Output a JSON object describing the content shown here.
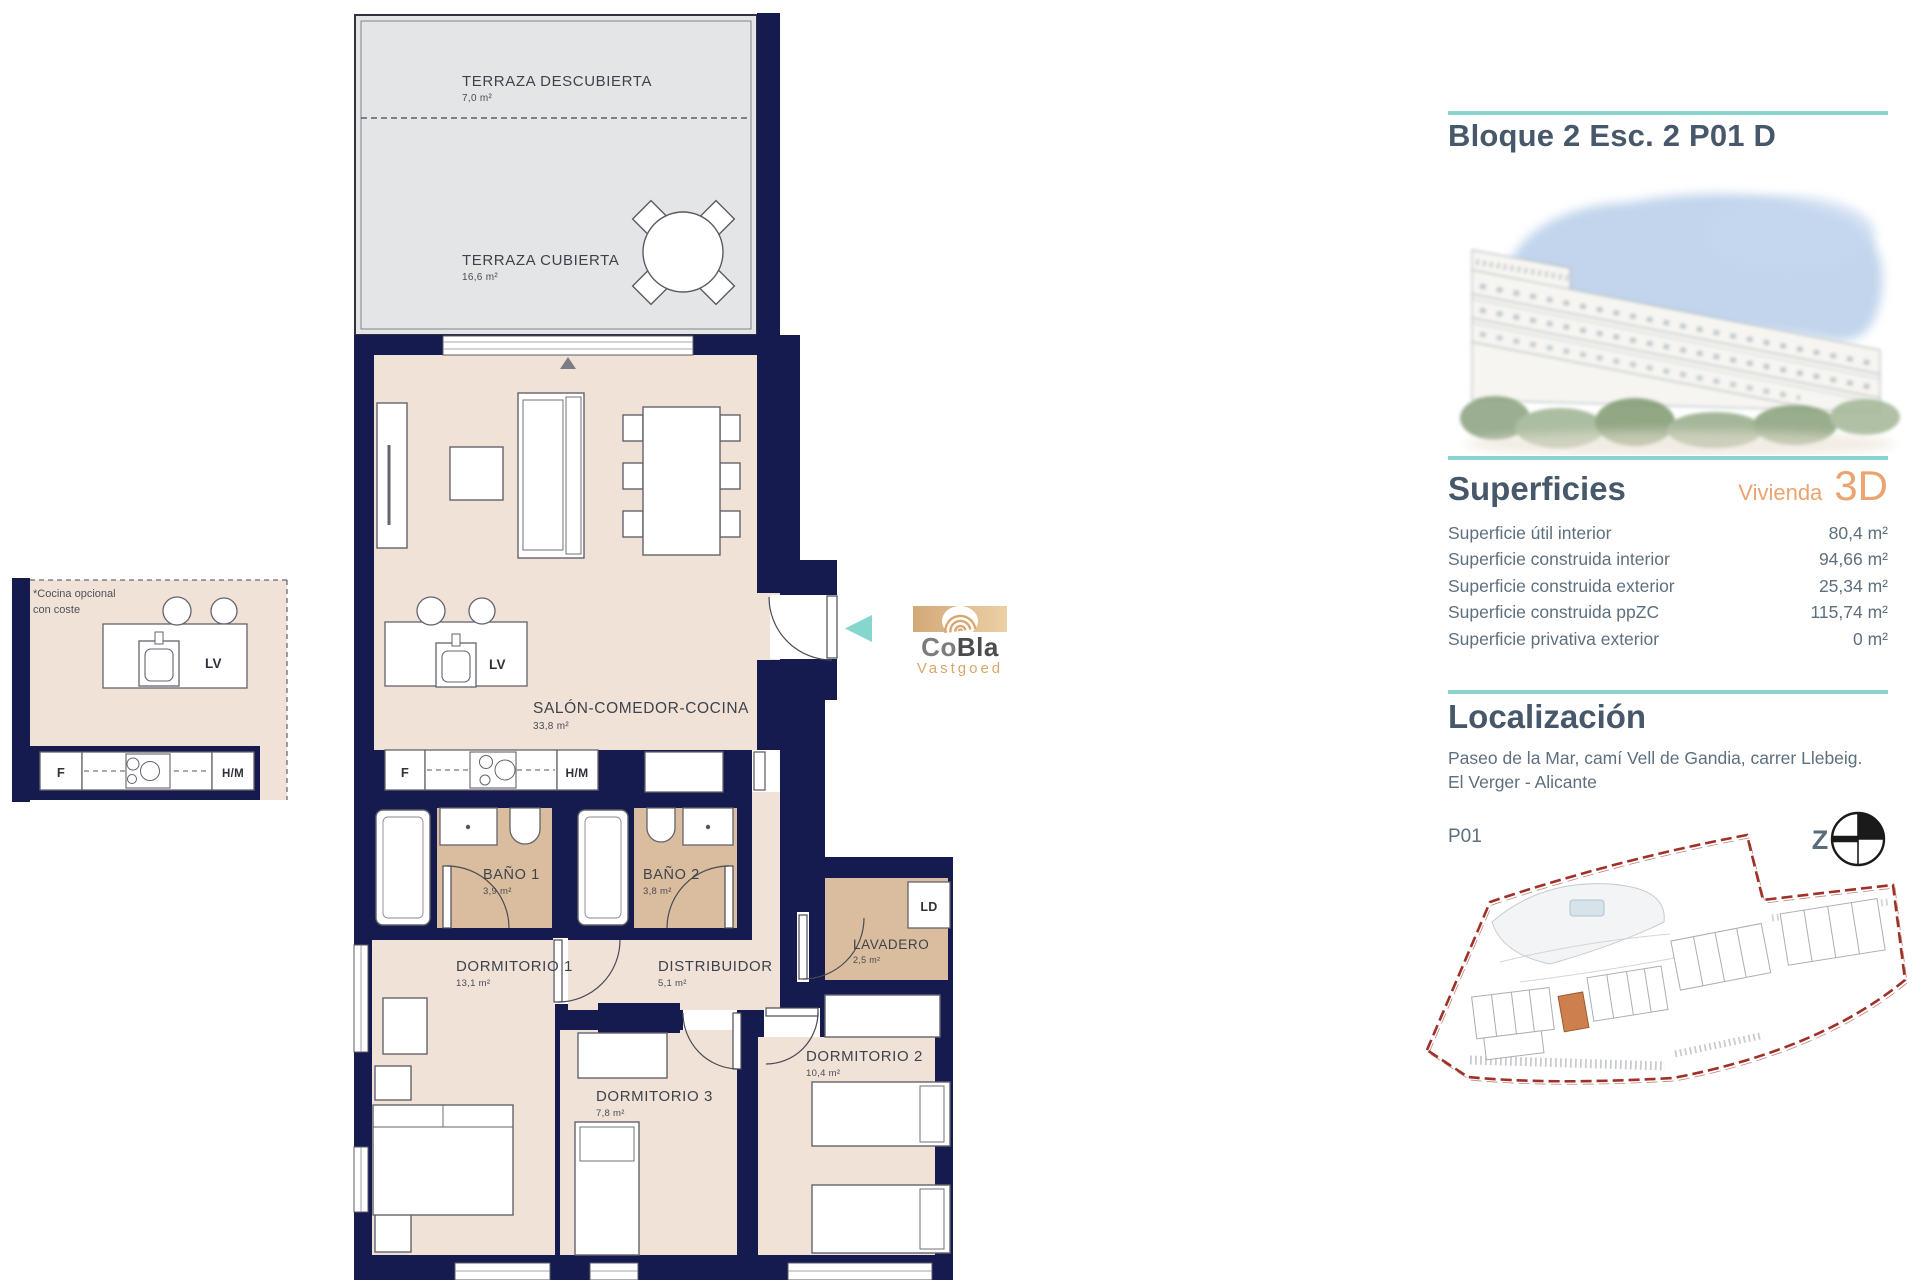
{
  "plan": {
    "rooms": {
      "terraza_descubierta": {
        "name": "TERRAZA DESCUBIERTA",
        "area": "7,0 m²"
      },
      "terraza_cubierta": {
        "name": "TERRAZA CUBIERTA",
        "area": "16,6 m²"
      },
      "salon": {
        "name": "SALÓN-COMEDOR-COCINA",
        "area": "33,8 m²"
      },
      "bano1": {
        "name": "BAÑO 1",
        "area": "3,9 m²"
      },
      "bano2": {
        "name": "BAÑO 2",
        "area": "3,8 m²"
      },
      "dormitorio1": {
        "name": "DORMITORIO 1",
        "area": "13,1 m²"
      },
      "distribuidor": {
        "name": "DISTRIBUIDOR",
        "area": "5,1 m²"
      },
      "lavadero": {
        "name": "LAVADERO",
        "area": "2,5 m²"
      },
      "dormitorio2": {
        "name": "DORMITORIO 2",
        "area": "10,4 m²"
      },
      "dormitorio3": {
        "name": "DORMITORIO 3",
        "area": "7,8 m²"
      }
    },
    "labels": {
      "fridge": "F",
      "dishwasher": "LV",
      "oven_microwave": "H/M",
      "laundry_unit": "LD"
    },
    "optional_kitchen_note_1": "*Cocina opcional",
    "optional_kitchen_note_2": "con coste"
  },
  "watermark": {
    "brand_co": "Co",
    "brand_bla": "Bla",
    "subtitle": "Vastgoed"
  },
  "sidebar": {
    "title": "Bloque 2 Esc. 2 P01 D",
    "superficies": {
      "heading": "Superficies",
      "dwelling_label": "Vivienda",
      "dwelling_code": "3D",
      "rows": [
        {
          "label": "Superficie útil interior",
          "value": "80,4 m²"
        },
        {
          "label": "Superficie construida interior",
          "value": "94,66 m²"
        },
        {
          "label": "Superficie construida exterior",
          "value": "25,34 m²"
        },
        {
          "label": "Superficie construida ppZC",
          "value": "115,74 m²"
        },
        {
          "label": "Superficie privativa exterior",
          "value": "0 m²"
        }
      ]
    },
    "localizacion": {
      "heading": "Localización",
      "address": "Paseo de la Mar, camí Vell de Gandia, carrer Llebeig. El Verger - Alicante",
      "floor_label": "P01",
      "compass_letter": "Z"
    }
  },
  "colors": {
    "wall": "#151b4e",
    "floor": "#f1e2d8",
    "wet_floor": "#d9bd9e",
    "terrace": "#e4e5e7",
    "teal": "#8bd4cd",
    "accent_orange": "#eba36f",
    "heading": "#47586a",
    "body_text": "#5e6f7d",
    "site_boundary": "#9e3128",
    "site_highlight": "#cd7f4e"
  }
}
